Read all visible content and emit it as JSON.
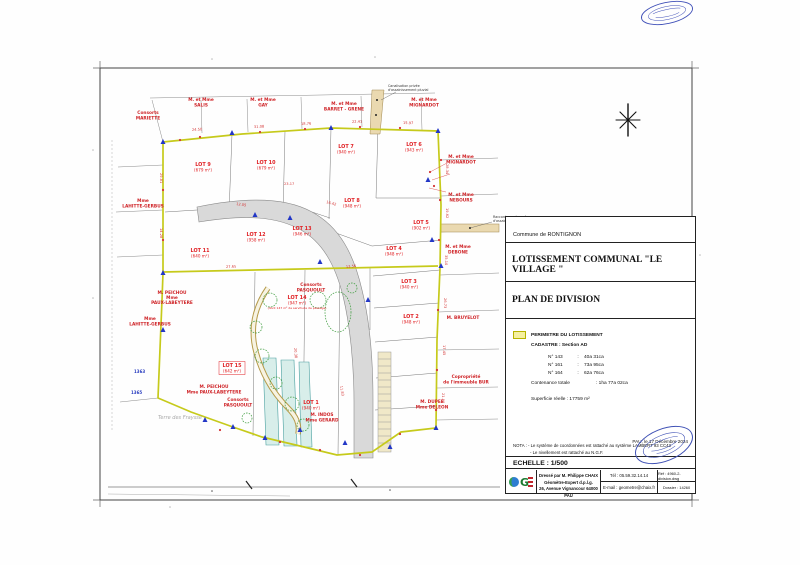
{
  "title_block": {
    "commune_label": "Commune  de  RONTIGNON",
    "title": "LOTISSEMENT  COMMUNAL  \"LE VILLAGE \"",
    "subtitle": "PLAN DE DIVISION",
    "legend": {
      "perimeter_label": "PERIMETRE  DU  LOTISSEMENT",
      "cadastre_label": "CADASTRE : Section AD",
      "parcels": [
        {
          "num": "N° 143",
          "sep": ":",
          "area": "40a 31ca"
        },
        {
          "num": "N° 161",
          "sep": ":",
          "area": "73a 95ca"
        },
        {
          "num": "N° 164",
          "sep": ":",
          "area": "62a 76ca"
        }
      ],
      "total_label": "Contenance totale",
      "total_value": ":  1ha 77a 02ca",
      "superficie_label": "Superficie réelle :",
      "superficie_value": "17759 m²"
    },
    "date": "PAU, le 17 Décembre 2024",
    "nota_line1": "NOTA : - Le système de coordonnées est rattaché au système LAMBERT 93 CC43",
    "nota_line2": "- Le nivellement est rattaché au N.G.F.",
    "echelle": "ECHELLE : 1/500",
    "firm": {
      "line1": "Dressé par M. Philippe CHAIX",
      "line2": "Géomètre-Expert d.p.l.g.",
      "line3": "26, Avenue Vignancour 64000 PAU",
      "tel": "Tél : 05.59.32.14.14",
      "email": "E-mail : geometre@chaix.fr",
      "ref": "Réf : 4960-2-division.dwg",
      "dossier": "Dossier : 14260"
    }
  },
  "map": {
    "north_label": "N",
    "lots": [
      {
        "name": "LOT 1",
        "area": "(940 m²)"
      },
      {
        "name": "LOT 2",
        "area": "(948 m²)"
      },
      {
        "name": "LOT 3",
        "area": "(940 m²)"
      },
      {
        "name": "LOT 4",
        "area": "(948 m²)"
      },
      {
        "name": "LOT 5",
        "area": "(902 m²)"
      },
      {
        "name": "LOT 6",
        "area": "(943 m²)"
      },
      {
        "name": "LOT 7",
        "area": "(940 m²)"
      },
      {
        "name": "LOT 8",
        "area": "(948 m²)"
      },
      {
        "name": "LOT 9",
        "area": "(679 m²)"
      },
      {
        "name": "LOT 10",
        "area": "(679 m²)"
      },
      {
        "name": "LOT 11",
        "area": "(640 m²)"
      },
      {
        "name": "LOT 12",
        "area": "(958 m²)"
      },
      {
        "name": "LOT 13",
        "area": "(946 m²)"
      },
      {
        "name": "LOT 14",
        "area": "(947 m²)"
      },
      {
        "name": "LOT 15",
        "area": "(642 m²)"
      }
    ],
    "owners": [
      {
        "l1": "Consorts",
        "l2": "MARIETTE"
      },
      {
        "l1": "M. et Mme",
        "l2": "SALIS"
      },
      {
        "l1": "M. et Mme",
        "l2": "GAY"
      },
      {
        "l1": "M. et Mme",
        "l2": "BARRET - GRENE"
      },
      {
        "l1": "M. et Mme",
        "l2": "MIGNARDOT"
      },
      {
        "l1": "M. et Mme",
        "l2": "MIGNARDOT"
      },
      {
        "l1": "M. et Mme",
        "l2": "NEBOURS"
      },
      {
        "l1": "M. et Mme",
        "l2": "DEBONE"
      },
      {
        "l1": "M. BRUYELOT"
      },
      {
        "l1": "Copropriété",
        "l2": "de l'immeuble BUR"
      },
      {
        "l1": "M. DUPEE",
        "l2": "Mme DELEON"
      },
      {
        "l1": "Mme",
        "l2": "LAHITTE-GERBUS"
      },
      {
        "l1": "Mme",
        "l2": "LAHITTE-GERBUS"
      },
      {
        "l1": "M. PEICHOU",
        "l2": "Mme",
        "l3": "PAUX-LABEYTERE"
      },
      {
        "l1": "M. PEICHOU",
        "l2": "Mme PAUX-LABEYTERE"
      },
      {
        "l1": "Consorts",
        "l2": "PASQUOULT"
      },
      {
        "l1": "Consorts",
        "l2": "PASQUOULT"
      },
      {
        "l1": "M. INDOS",
        "l2": "Mme GERARD"
      }
    ],
    "dimensions": [
      "24.50",
      "31.08",
      "18.76",
      "22.41",
      "15.97",
      "28.34",
      "19.62",
      "35.10",
      "26.73",
      "17.45",
      "21.90",
      "29.81",
      "14.28",
      "12.05",
      "23.17",
      "16.42",
      "27.65",
      "13.56",
      "20.38",
      "11.83"
    ],
    "parcel_ids": [
      "1363",
      "1365"
    ],
    "annotations": {
      "canalisation1": "Canalisation privée",
      "canalisation2": "d'assainissement pluvial",
      "raccord1": "Raccordement au réseau",
      "raccord2": "d'assainissement public",
      "servitude": "(dont 147 m² de servitude de passage)",
      "terre": "Terre des Fraysse"
    },
    "colors": {
      "perimeter": "#c6ca1b",
      "road_fill": "#d9d9d9",
      "lot_text": "#e02024",
      "owner_text": "#cf2428",
      "marker_blue": "#2337c6",
      "building_strip": "#d8eeea",
      "pipe_strip": "#ead9b0",
      "stamp_blue": "#3f51b5"
    }
  }
}
